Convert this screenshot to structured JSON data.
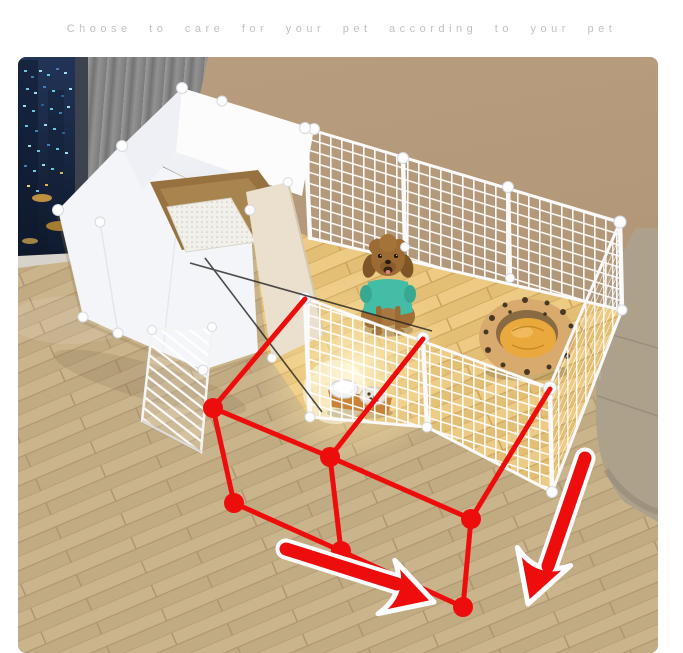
{
  "header": {
    "tagline": "Choose to care for your pet according to your pet"
  },
  "scene": {
    "description": "Living room with modular DIY pet playpen, toy poodle in teal shirt, leopard pet bed, litter enclosure, feeding bowls and red expansion diagram with arrows",
    "colors": {
      "accent_red": "#ee0d0d",
      "wall_tan": "#b29878",
      "floor_wood": "#cbb58d",
      "pen_floor_sunlit": "#e9c77c",
      "panel_white": "#f3f5f8",
      "mesh_white": "#ffffff",
      "curtain_gray": "#8c8c8c",
      "sofa_beige": "#ada18c",
      "window_night": "#18263f",
      "bed_leopard_tan": "#d9aa6e",
      "bed_cushion_yellow": "#e9a93c",
      "dog_fur_brown": "#9c6a33",
      "dog_shirt_teal": "#43bda6",
      "litter_tray_brown": "#97713f",
      "divider_cream": "#ebe0cd"
    },
    "diagram": {
      "dot_count": 6,
      "arrow_count": 2
    }
  }
}
